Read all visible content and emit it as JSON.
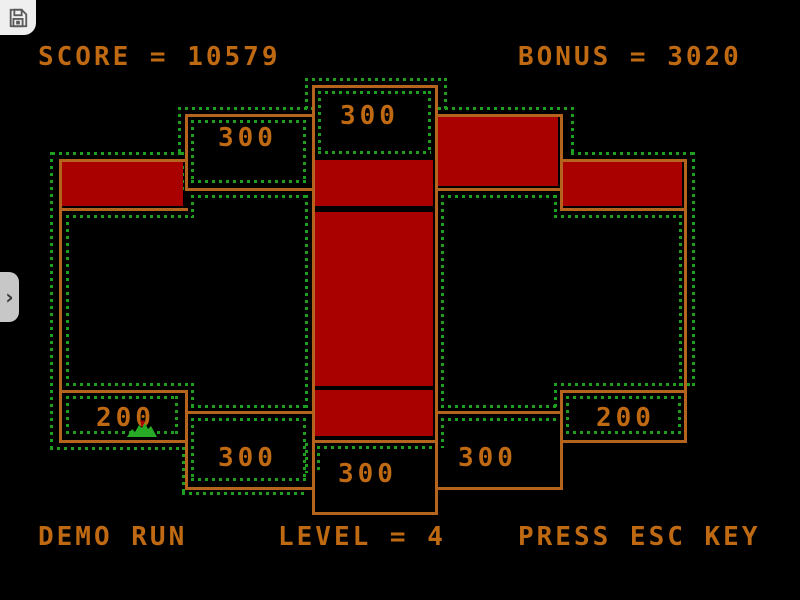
{
  "colors": {
    "background": "#000000",
    "wall_orange": "#b4641c",
    "text_orange": "#bf6a12",
    "piston_red": "#a90000",
    "trail_green": "#1f9e1f",
    "overlay_button_bg": "#efefef",
    "tab_bg": "#c7c7c7",
    "icon_gray": "#5a5a5a"
  },
  "hud": {
    "score_text": "SCORE = 10579",
    "score_value": 10579,
    "bonus_text": "BONUS = 3020",
    "bonus_value": 3020
  },
  "footer": {
    "demo_text": "DEMO RUN",
    "level_text": "LEVEL = 4",
    "level_value": 4,
    "esc_text": "PRESS ESC KEY"
  },
  "board": {
    "labels": [
      {
        "value": "300"
      },
      {
        "value": "300"
      },
      {
        "value": "200"
      },
      {
        "value": "300"
      },
      {
        "value": "300"
      },
      {
        "value": "300"
      },
      {
        "value": "200"
      }
    ]
  },
  "overlay": {
    "chevron_glyph": "›"
  }
}
